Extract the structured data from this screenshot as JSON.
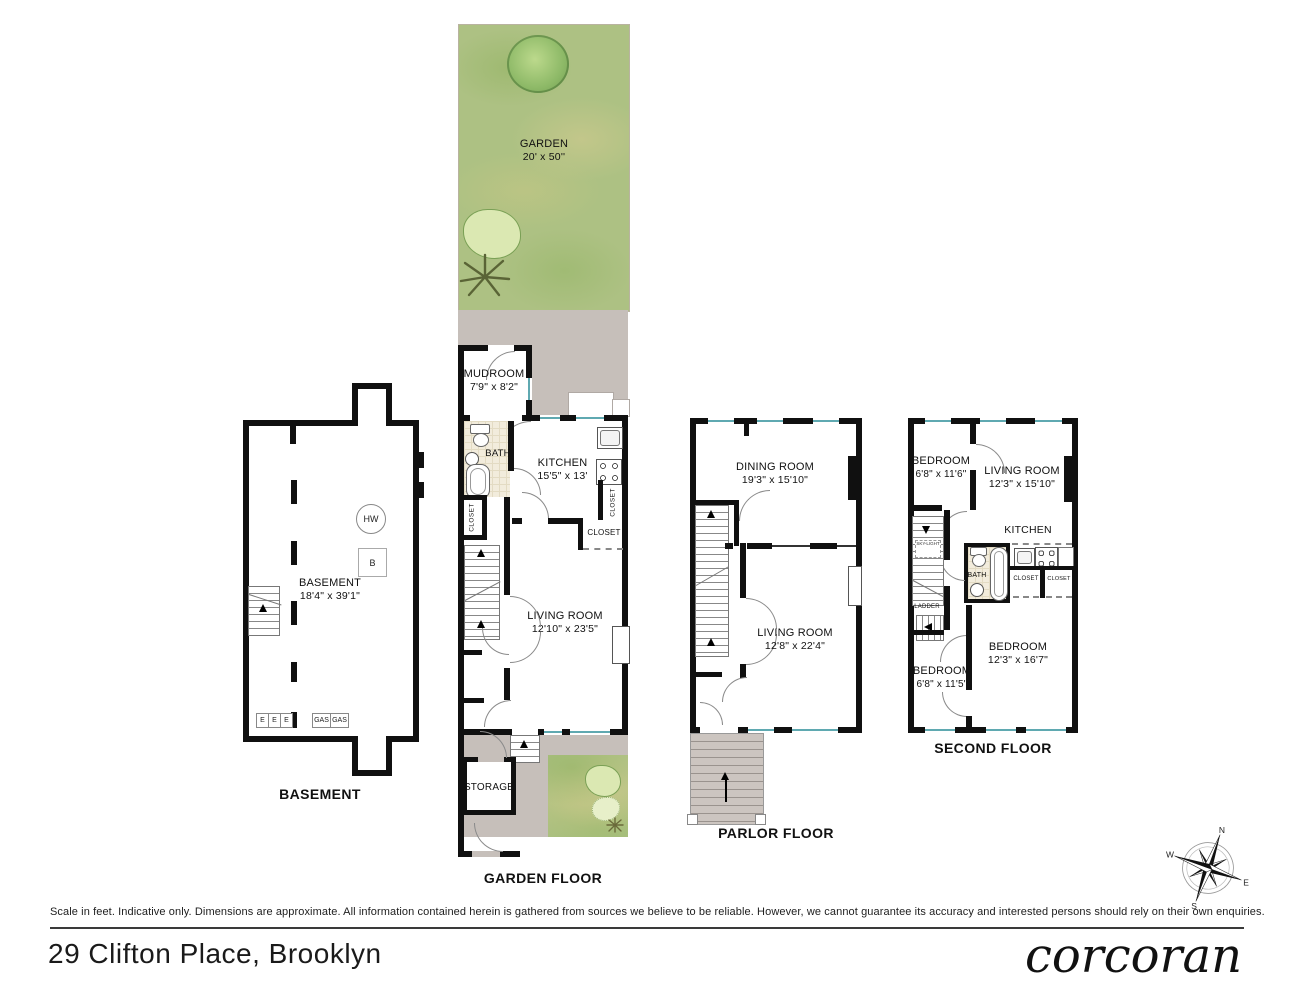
{
  "footer": {
    "disclaimer": "Scale in feet. Indicative only. Dimensions are approximate. All information contained herein is gathered from sources we believe to be reliable. However, we cannot guarantee its accuracy and interested persons should rely on their own enquiries.",
    "address": "29 Clifton Place, Brooklyn",
    "brand": "corcoran"
  },
  "compass": {
    "n": "N",
    "e": "E",
    "s": "S",
    "w": "W"
  },
  "garden": {
    "name": "GARDEN",
    "dims": "20' x 50''"
  },
  "basement": {
    "floor_label": "BASEMENT",
    "room": "BASEMENT",
    "dims": "18'4\" x 39'1\"",
    "hw": "HW",
    "boiler": "B",
    "meters": [
      "E",
      "E",
      "E"
    ],
    "gas": [
      "GAS",
      "GAS"
    ]
  },
  "garden_floor": {
    "floor_label": "GARDEN FLOOR",
    "mudroom": "MUDROOM",
    "mudroom_dims": "7'9\" x 8'2\"",
    "bath": "BATH",
    "kitchen": "KITCHEN",
    "kitchen_dims": "15'5\" x 13'",
    "living": "LIVING ROOM",
    "living_dims": "12'10\" x 23'5\"",
    "storage": "STORAGE",
    "closet_left": "CLOSET",
    "closet_right": "CLOSET",
    "closet_mid": "CLOSET"
  },
  "parlor": {
    "floor_label": "PARLOR FLOOR",
    "dining": "DINING ROOM",
    "dining_dims": "19'3\" x 15'10\"",
    "living": "LIVING ROOM",
    "living_dims": "12'8\" x 22'4\""
  },
  "second": {
    "floor_label": "SECOND FLOOR",
    "bedroom1": "BEDROOM",
    "bedroom1_dims": "6'8\" x 11'6\"",
    "living": "LIVING ROOM",
    "living_dims": "12'3\" x 15'10\"",
    "kitchen": "KITCHEN",
    "bath": "BATH",
    "skylight": "SKY-LIGHT",
    "ladder": "LADDER",
    "closet1": "CLOSET",
    "closet2": "CLOSET",
    "bedroom2": "BEDROOM",
    "bedroom2_dims": "6'8\" x 11'5\"",
    "bedroom3": "BEDROOM",
    "bedroom3_dims": "12'3\" x 16'7\""
  },
  "colors": {
    "wall": "#101010",
    "window": "#5fa9b1",
    "grass": "#adc183",
    "deck": "#c6bfba",
    "tile": "#f2ecdc"
  }
}
